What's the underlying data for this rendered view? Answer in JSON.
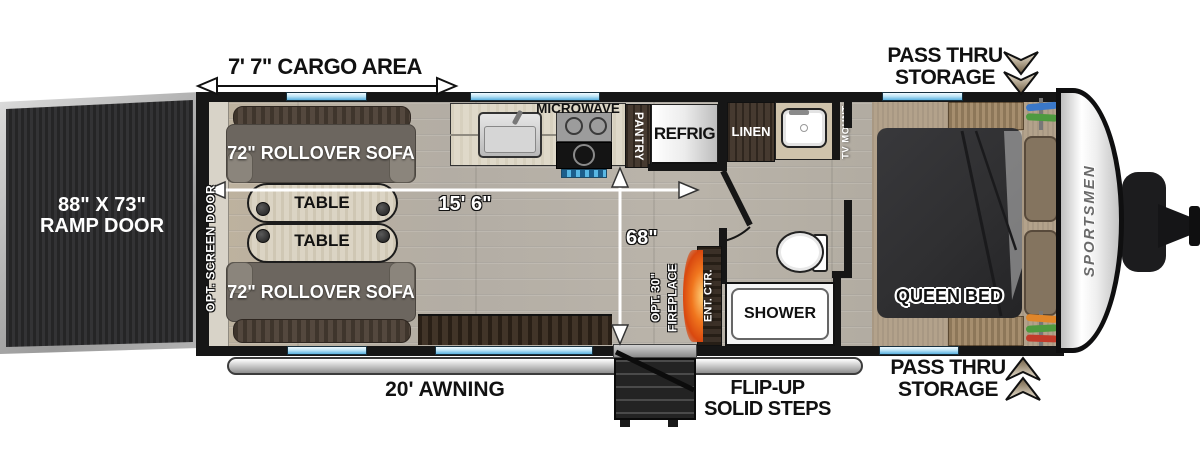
{
  "colors": {
    "wall": "#161616",
    "floor_wood": "#b7b1a7",
    "carpet_tan": "#b3a28b",
    "window_blue": "#5ab1e0",
    "sofa_gray": "#6c665f",
    "cabinet_brown": "#3f3228",
    "fireplace_orange": "#f0761e",
    "bed_charcoal": "#2f2f31",
    "ramp_dark": "#2b2b2d",
    "accent_silver": "#c9c9c9"
  },
  "exterior": {
    "cargo_area_dim": "7' 7\" CARGO AREA",
    "ramp_door_size": "88\" X 73\"",
    "ramp_door_name": "RAMP DOOR",
    "awning_label": "20' AWNING",
    "steps_label_line1": "FLIP-UP",
    "steps_label_line2": "SOLID STEPS",
    "pass_thru_line1": "PASS THRU",
    "pass_thru_line2": "STORAGE",
    "screen_door_label": "OPT. SCREEN DOOR",
    "brand_logo": "SPORTSMEN"
  },
  "dimensions": {
    "interior_length": "15' 6\"",
    "garage_width": "68\""
  },
  "furniture": {
    "sofa_label": "72\" ROLLOVER SOFA",
    "table_label": "TABLE",
    "microwave_label": "MICROWAVE",
    "pantry_label": "PANTRY",
    "refrig_label": "REFRIG",
    "linen_label": "LINEN",
    "tv_mount_label": "TV MOUNT",
    "queen_bed_label": "QUEEN BED",
    "shower_label": "SHOWER",
    "ent_ctr_label": "ENT. CTR.",
    "fireplace_label_line1": "OPT. 30\"",
    "fireplace_label_line2": "FIREPLACE"
  }
}
